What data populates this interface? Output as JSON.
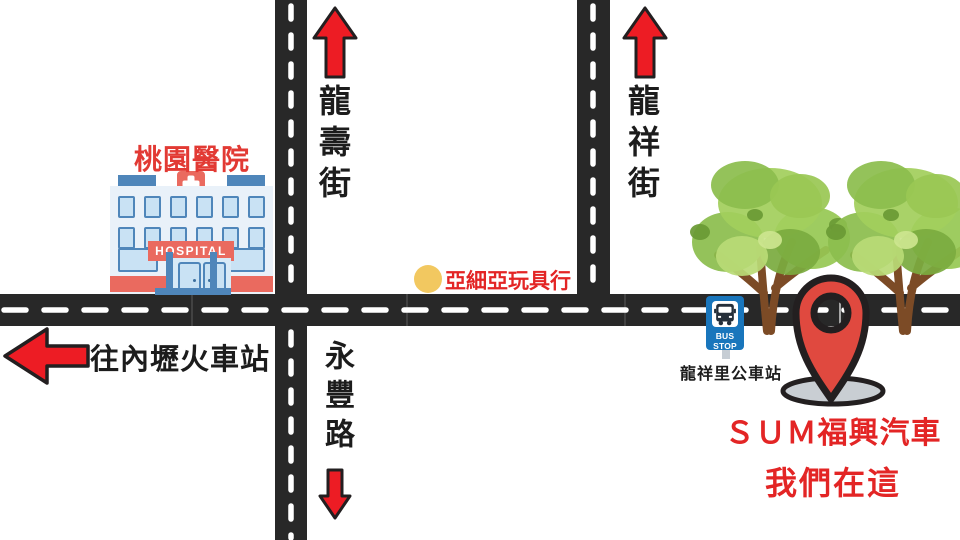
{
  "title": "store-location-map",
  "colors": {
    "road": "#282828",
    "dash": "#ffffff",
    "arrow-red": "#ed1c24",
    "outline": "#231f20",
    "label-red": "#e32525",
    "hospital-label-red": "#e23a34",
    "text-black": "#1c1c1c",
    "pin-red": "#e0493f",
    "pin-shadow": "#c9ced3",
    "bus-blue": "#1976bc",
    "toy-dot-yellow": "#f2c860",
    "facade": "#e9f1f9",
    "window-fill": "#c9e2f4",
    "window-frame": "#4f86ba",
    "salmon": "#ea6a5f",
    "tree-green": "#97c854",
    "trunk-brown": "#7c4b26"
  },
  "hospital": {
    "name": "桃園醫院",
    "sign_text": "HOSPITAL"
  },
  "streets": {
    "longshou": "龍壽街",
    "yongfeng": "永豐路",
    "longxiang": "龍祥街"
  },
  "landmarks": {
    "toy_store": "亞細亞玩具行",
    "train_station": "往內壢火車站",
    "bus_stop_sign": "BUS STOP",
    "bus_stop_name": "龍祥里公車站",
    "destination_line1": "ＳＵＭ福興汽車",
    "destination_line2": "我們在這"
  }
}
